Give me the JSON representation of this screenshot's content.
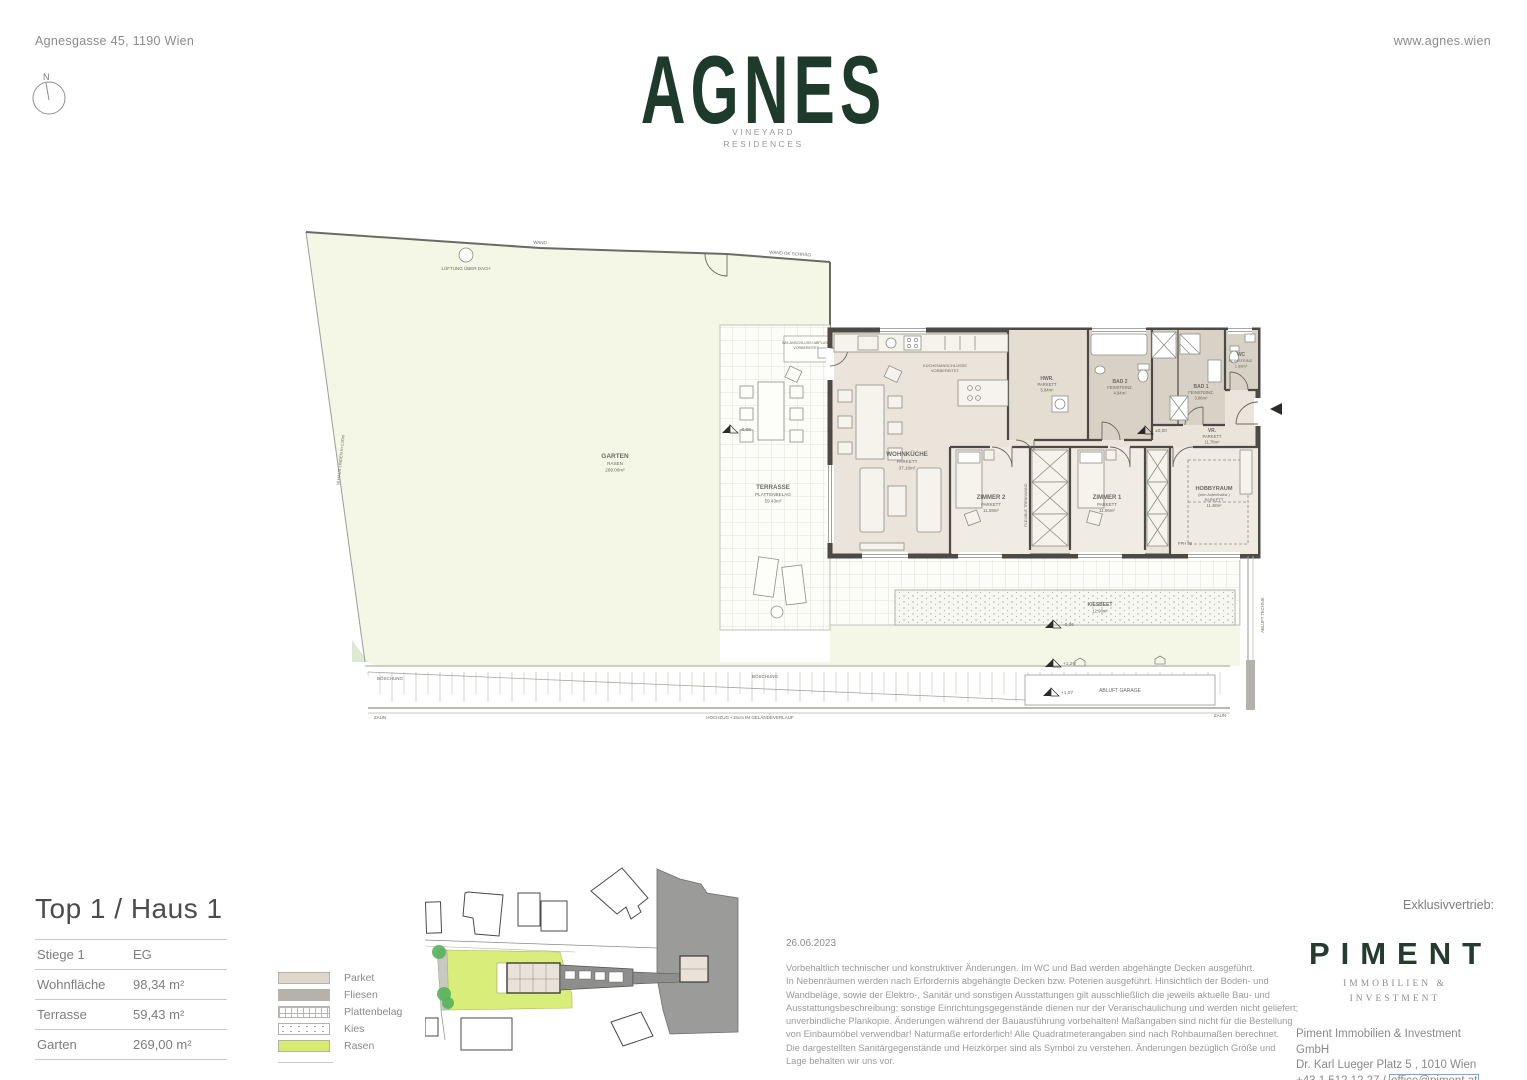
{
  "header": {
    "address": "Agnesgasse 45, 1190 Wien",
    "website": "www.agnes.wien",
    "logo": "AGNES",
    "sub1": "VINEYARD",
    "sub2": "RESIDENCES",
    "compass": "N"
  },
  "plan": {
    "boundary": {
      "wand": "WAND",
      "wand_ok_schraeg": "WAND OK SCHRÄG",
      "lueftung": "LÜFTUNG ÜBER DACH",
      "left_note": "W.HAUS LINDEN h=1.00m",
      "boeschung_left": "BÖSCHUNG",
      "boeschung_right": "BÖSCHUNG",
      "zaun_left": "ZAUN",
      "zaun_right": "ZAUN",
      "hochzug": "HOCHZUG +15cm IM GELÄNDEVERLAUF"
    },
    "notes": {
      "wm1": "WM-ANSCHLUSS+ABFLUSS",
      "wm2": "VORBEREITET",
      "kueche1": "KÜCHENANSCHLÜSSE",
      "kueche2": "VORBEREITET",
      "flexible": "FLEXIBLE TRENNWAND",
      "fph": "FPH 90",
      "abluft_garage": "ABLUFT GARAGE",
      "abluft_technik": "ABLUFT TECHNIK"
    },
    "rooms": {
      "garten": {
        "name": "GARTEN",
        "sub": "RASEN",
        "area": "269.00m²"
      },
      "terrasse": {
        "name": "TERRASSE",
        "sub": "PLATTENBELAG",
        "area": "59.43m²"
      },
      "wohnkueche": {
        "name": "WOHNKÜCHE",
        "sub": "PARKETT",
        "area": "37.16m²"
      },
      "hwr": {
        "name": "HWR.",
        "sub": "PARKETT",
        "area": "5.84m²"
      },
      "bad2": {
        "name": "BAD 2",
        "sub": "FEINSTEINZ.",
        "area": "4.94m²"
      },
      "bad1": {
        "name": "BAD 1",
        "sub": "FEINSTEINZ.",
        "area": "3.86m²"
      },
      "wc": {
        "name": "WC",
        "sub": "FEINSTEINZ.",
        "area": "1.88m²"
      },
      "vr": {
        "name": "VR.",
        "sub": "PARKETT",
        "area": "11.78m²"
      },
      "zimmer2": {
        "name": "ZIMMER 2",
        "sub": "PARKETT",
        "area": "11.08m²"
      },
      "zimmer1": {
        "name": "ZIMMER 1",
        "sub": "PARKETT",
        "area": "11.06m²"
      },
      "hobbyraum": {
        "name": "HOBBYRAUM",
        "sub": "(kein Aufenthaltsr.)",
        "sub2": "PARKETT",
        "area": "11.48m²"
      },
      "kiesbeet": {
        "name": "KIESBEET",
        "area": "12.98m²"
      }
    },
    "levels": {
      "terrasse": "-0,08",
      "eg": "±0,00",
      "kies": "-0,06",
      "garage_top": "+1,29",
      "garage_bottom": "+1,07"
    }
  },
  "info": {
    "title": "Top 1 / Haus 1",
    "rows": [
      {
        "label": "Stiege 1",
        "value": "EG"
      },
      {
        "label": "Wohnfläche",
        "value": "98,34 m²"
      },
      {
        "label": "Terrasse",
        "value": "59,43 m²"
      },
      {
        "label": "Garten",
        "value": "269,00 m²"
      }
    ]
  },
  "legend": {
    "items": [
      {
        "label": "Parket"
      },
      {
        "label": "Fliesen"
      },
      {
        "label": "Plattenbelag"
      },
      {
        "label": "Kies"
      },
      {
        "label": "Rasen"
      }
    ]
  },
  "colors": {
    "brand_green": "#1e3a2b",
    "rasen": "#d7ec6e",
    "parket": "#ded7c9",
    "fliesen": "#b5b2ab",
    "garden_fill": "#f4f6e6"
  },
  "footer": {
    "date": "26.06.2023",
    "disclaimer": "Vorbehaltlich technischer und konstruktiver Änderungen. Im WC und Bad werden abgehängte Decken ausgeführt.\nIn Nebenräumen werden nach Erfordernis abgehängte Decken bzw. Poterien ausgeführt. Hinsichtlich der Boden- und\nWandbeläge, sowie der Elektro-, Sanitär und sonstigen Ausstattungen gilt ausschließlich die jeweils aktuelle Bau- und\nAusstattungsbeschreibung; sonstige Einrichtungsgegenstände dienen nur der Veranschaulichung und werden nicht geliefert;\nunverbindliche Plankopie. Änderungen während der Bauausführung vorbehalten! Maßangaben sind nicht für die Bestellung\nvon Einbaumöbel verwendbar! Naturmaße erforderlich! Alle Quadratmeterangaben sind nach Rohbaumaßen berechnet.\nDie dargestellten Sanitärgegenstände und Heizkörper sind als Symbol zu verstehen. Änderungen bezüglich Größe und\nLage behalten wir uns vor.",
    "exklusiv": "Exklusivvertrieb:",
    "piment": "PIMENT",
    "piment_sub1": "IMMOBILIEN &",
    "piment_sub2": "INVESTMENT",
    "company": "Piment Immobilien & Investment GmbH",
    "address": "Dr. Karl Lueger Platz 5 , 1010 Wien",
    "phone_prefix": "+43 1 512 12 27 / ",
    "email": "office@piment.at"
  }
}
